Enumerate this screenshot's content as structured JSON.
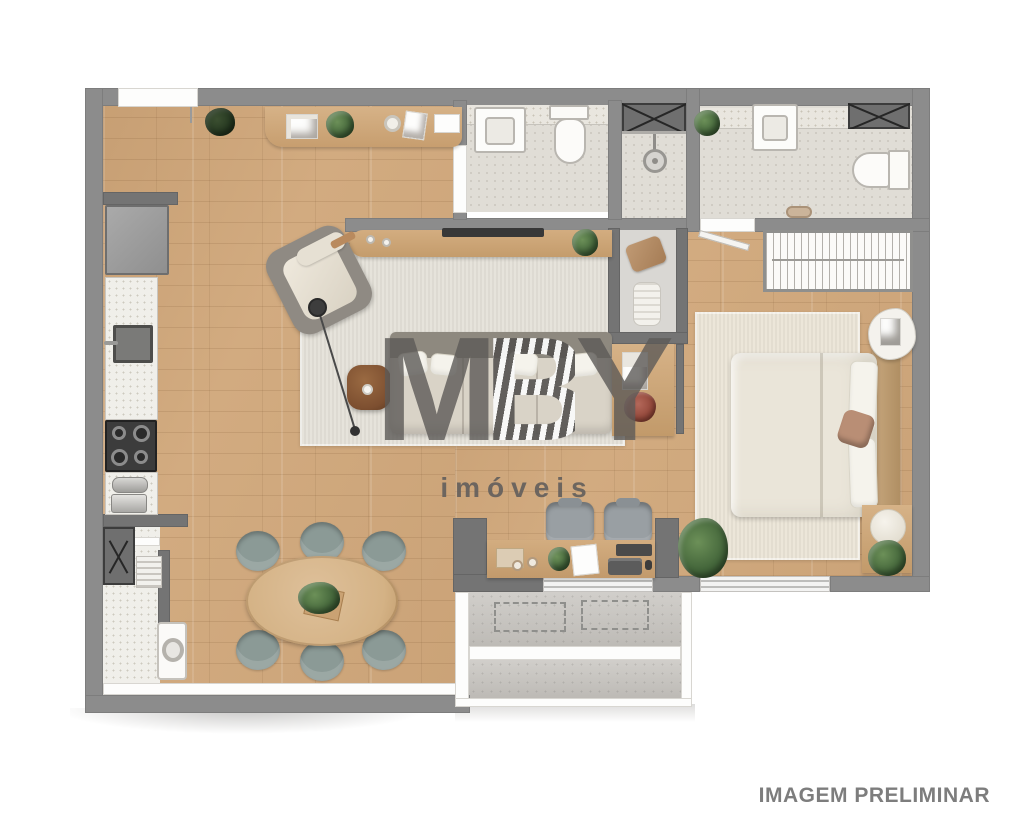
{
  "watermark": {
    "letters": [
      "M",
      "B",
      "Y"
    ],
    "subtitle": "imóveis"
  },
  "footer": {
    "disclaimer": "IMAGEM PRELIMINAR"
  },
  "palette": {
    "wall": "#8c8c8c",
    "wall-dark": "#747474",
    "wood": "#d2ab80",
    "bath-floor": "#e0ddd6",
    "service-floor": "#f0efea",
    "concrete": "#c7c4bf",
    "rug-living": "#e6e3db",
    "rug-bed": "#ece6d9",
    "chair": "#8b9a96",
    "ochair": "#999fa3",
    "sofa-seat": "#d9d3c7",
    "sofa-back": "#8e897f",
    "bed-duvet": "#eae5d9",
    "headboard": "#c8a87f",
    "table-wood": "#d4b285",
    "coffee-table": "#7d4f30",
    "accent-pillow": "#b98e75"
  }
}
